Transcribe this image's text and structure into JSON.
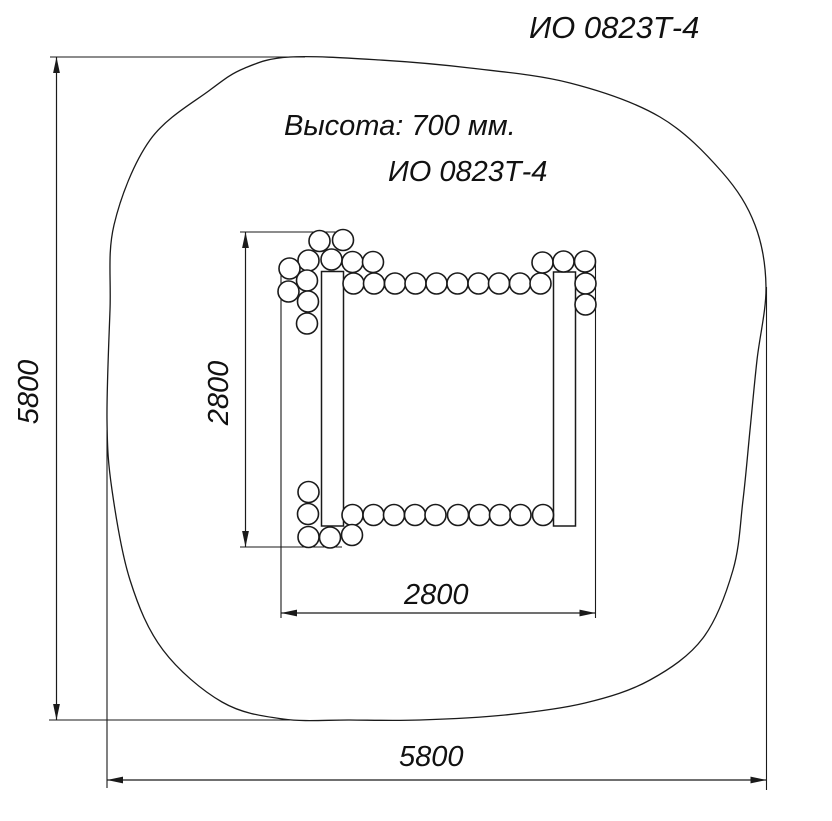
{
  "page": {
    "background": "#ffffff",
    "width": 832,
    "height": 821
  },
  "header": {
    "top_right_label": "ИО 0823Т-4"
  },
  "annotations": {
    "height_note": "Высота: 700 мм.",
    "model_label": "ИО 0823Т-4"
  },
  "dimensions": {
    "overall_height": {
      "value": "5800",
      "orientation": "vertical",
      "measures": "safety-zone-height"
    },
    "overall_width": {
      "value": "5800",
      "orientation": "horizontal",
      "measures": "safety-zone-width"
    },
    "inner_height": {
      "value": "2800",
      "orientation": "vertical",
      "measures": "equipment-depth"
    },
    "inner_width": {
      "value": "2800",
      "orientation": "horizontal",
      "measures": "equipment-width"
    }
  },
  "drawing": {
    "stroke_color": "#1a1a1a",
    "fill_color": "#ffffff",
    "safety_zone_outline": {
      "points": [
        [
          290,
          57
        ],
        [
          380,
          60
        ],
        [
          470,
          68
        ],
        [
          570,
          83
        ],
        [
          660,
          117
        ],
        [
          722,
          172
        ],
        [
          755,
          225
        ],
        [
          766,
          287
        ],
        [
          757,
          360
        ],
        [
          750,
          430
        ],
        [
          743,
          500
        ],
        [
          733,
          570
        ],
        [
          703,
          638
        ],
        [
          650,
          680
        ],
        [
          585,
          703
        ],
        [
          505,
          715
        ],
        [
          420,
          720
        ],
        [
          350,
          720
        ],
        [
          283,
          719
        ],
        [
          222,
          702
        ],
        [
          163,
          650
        ],
        [
          130,
          580
        ],
        [
          112,
          490
        ],
        [
          107,
          420
        ],
        [
          110,
          310
        ],
        [
          114,
          225
        ],
        [
          150,
          140
        ],
        [
          210,
          90
        ],
        [
          245,
          68
        ]
      ]
    },
    "extension_lines": [
      [
        50,
        57,
        305,
        57
      ],
      [
        49,
        720,
        290,
        720
      ],
      [
        107,
        430,
        107,
        788
      ],
      [
        766.5,
        287,
        766.5,
        790
      ],
      [
        240,
        232,
        342,
        232
      ],
      [
        240,
        547,
        342,
        547
      ],
      [
        281,
        263,
        281,
        618
      ],
      [
        595.5,
        262,
        595.5,
        618
      ]
    ],
    "dimension_lines": [
      {
        "x1": 56.5,
        "y1": 57,
        "x2": 56.5,
        "y2": 720,
        "arrows": "both"
      },
      {
        "x1": 107,
        "y1": 780,
        "x2": 766.5,
        "y2": 780,
        "arrows": "both"
      },
      {
        "x1": 245.5,
        "y1": 232,
        "x2": 245.5,
        "y2": 547,
        "arrows": "both"
      },
      {
        "x1": 281,
        "y1": 613,
        "x2": 595.5,
        "y2": 613,
        "arrows": "both"
      }
    ],
    "walls": [
      {
        "x": 321.5,
        "y": 271.5,
        "w": 22,
        "h": 254.5
      },
      {
        "x": 553.5,
        "y": 272,
        "w": 22,
        "h": 254
      }
    ],
    "log_circles": {
      "r": 10.5,
      "centers": [
        [
          319.5,
          241
        ],
        [
          343,
          240
        ],
        [
          308.5,
          260.5
        ],
        [
          331.5,
          259.5
        ],
        [
          352.5,
          262
        ],
        [
          373,
          262
        ],
        [
          289.5,
          268.5
        ],
        [
          307,
          280.5
        ],
        [
          288.5,
          291.5
        ],
        [
          308,
          301.5
        ],
        [
          307,
          323.5
        ],
        [
          353.5,
          283.5
        ],
        [
          374,
          283.5
        ],
        [
          395,
          283.5
        ],
        [
          415.5,
          283.5
        ],
        [
          436.5,
          283.5
        ],
        [
          457.5,
          283.5
        ],
        [
          478.5,
          283.5
        ],
        [
          499,
          283.5
        ],
        [
          520,
          283.5
        ],
        [
          540.5,
          283.5
        ],
        [
          542.5,
          262.5
        ],
        [
          563.5,
          261.5
        ],
        [
          585,
          261.5
        ],
        [
          585.5,
          283.5
        ],
        [
          585.5,
          304.5
        ],
        [
          352.5,
          515
        ],
        [
          373.5,
          515
        ],
        [
          394,
          515
        ],
        [
          415,
          515
        ],
        [
          435.5,
          515
        ],
        [
          458,
          515
        ],
        [
          479.5,
          515
        ],
        [
          500,
          515
        ],
        [
          520.5,
          515
        ],
        [
          543,
          515
        ],
        [
          308.5,
          492
        ],
        [
          308,
          514
        ],
        [
          308.5,
          537
        ],
        [
          330,
          537.5
        ],
        [
          352,
          535
        ]
      ]
    }
  }
}
